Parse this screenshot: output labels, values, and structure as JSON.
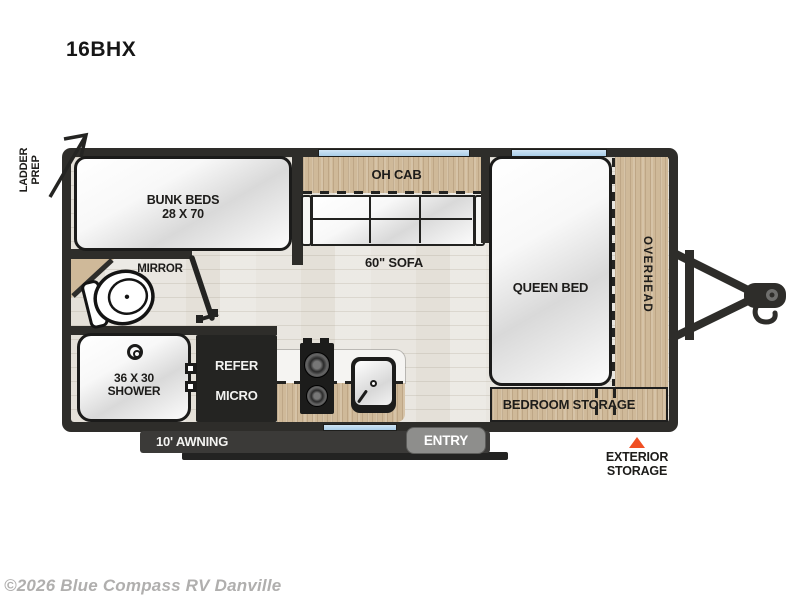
{
  "title": "16BHX",
  "watermark": "©2026 Blue Compass RV Danville",
  "colors": {
    "wall": "#2e2d2a",
    "wood": "#cfb999",
    "floor": "#e9e6e0",
    "window_blue": "#aed1ea",
    "exterior_storage_marker": "#f04f23",
    "awning_bar": "#3b3a38",
    "entry_gray": "#8e8e8c",
    "watermark_gray": "#b0afae"
  },
  "labels": {
    "ladder_prep_1": "LADDER",
    "ladder_prep_2": "PREP",
    "bunk_1": "BUNK BEDS",
    "bunk_2": "28 X 70",
    "mirror": "MIRROR",
    "oh_cab": "OH CAB",
    "sofa": "60\" SOFA",
    "queen_bed": "QUEEN BED",
    "overhead": "OVERHEAD",
    "bedroom_storage": "BEDROOM STORAGE",
    "shower_1": "36 X 30",
    "shower_2": "SHOWER",
    "refer": "REFER",
    "micro": "MICRO",
    "awning": "10' AWNING",
    "entry": "ENTRY",
    "exterior_storage_1": "EXTERIOR",
    "exterior_storage_2": "STORAGE"
  }
}
